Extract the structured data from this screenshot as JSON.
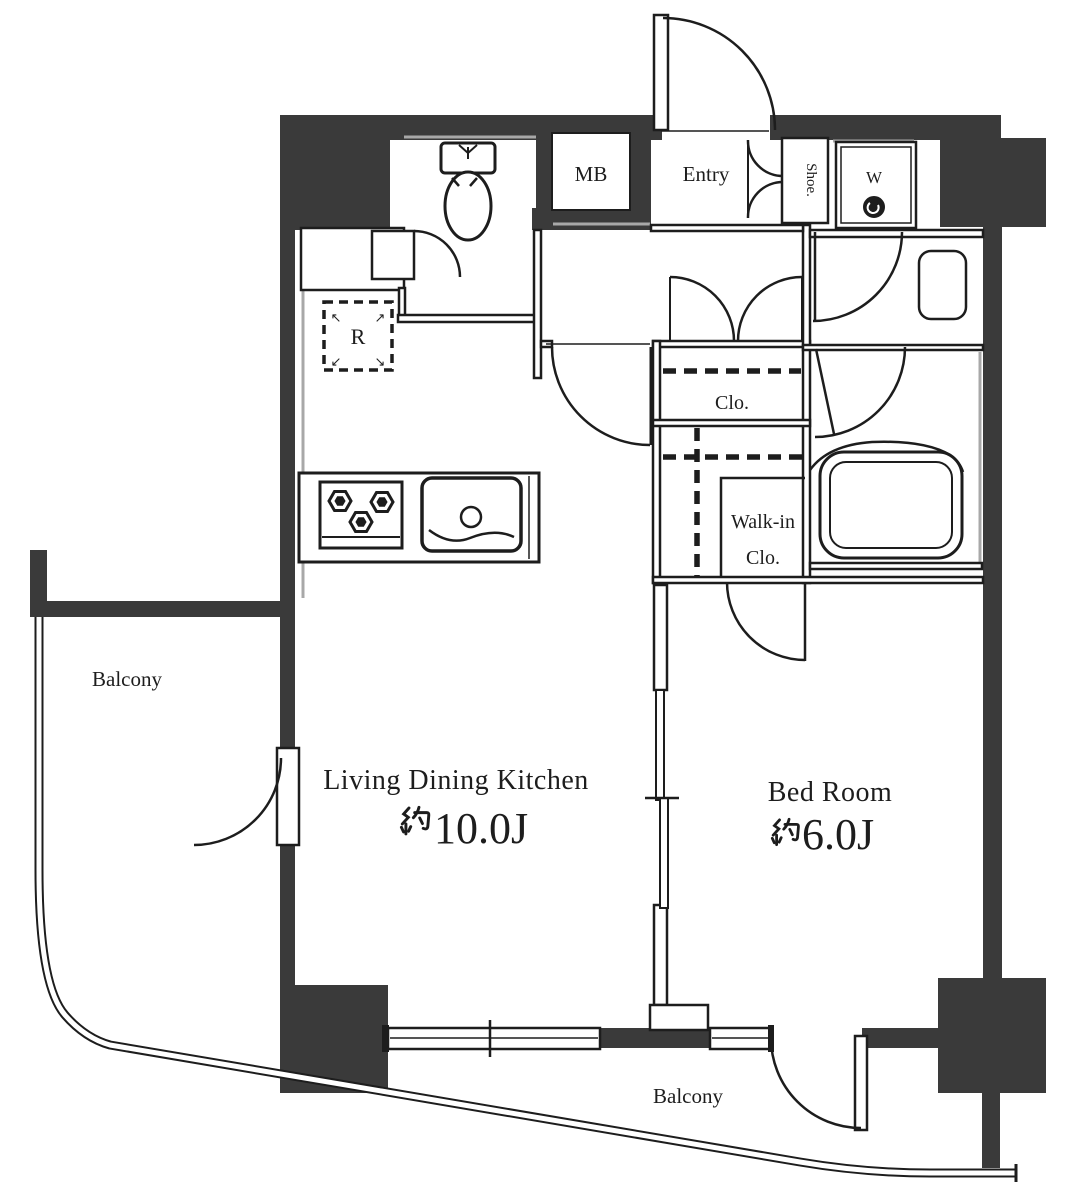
{
  "plan": {
    "rooms": {
      "ldk": {
        "name": "Living Dining Kitchen",
        "area": "約10.0J",
        "area_value": "10.0J"
      },
      "bedroom": {
        "name": "Bed Room",
        "area": "約6.0J",
        "area_value": "6.0J"
      },
      "entry": {
        "label": "Entry"
      },
      "closet": {
        "label": "Clo."
      },
      "walk_in_closet": {
        "line1": "Walk-in",
        "line2": "Clo."
      },
      "balcony_left": {
        "label": "Balcony"
      },
      "balcony_bottom": {
        "label": "Balcony"
      },
      "meter_box": {
        "label": "MB"
      },
      "shoe_cabinet": {
        "label": "Shoe."
      },
      "washer": {
        "label": "W"
      },
      "refrigerator": {
        "label": "R"
      }
    },
    "icons": {
      "refrigerator_arrows": {
        "tl": "↖",
        "tr": "↗",
        "bl": "↙",
        "br": "↘"
      }
    },
    "colors": {
      "wall": "#3a3a3a",
      "line": "#1d1d1d",
      "shadow": "#a8a8a8",
      "background": "#ffffff"
    }
  }
}
